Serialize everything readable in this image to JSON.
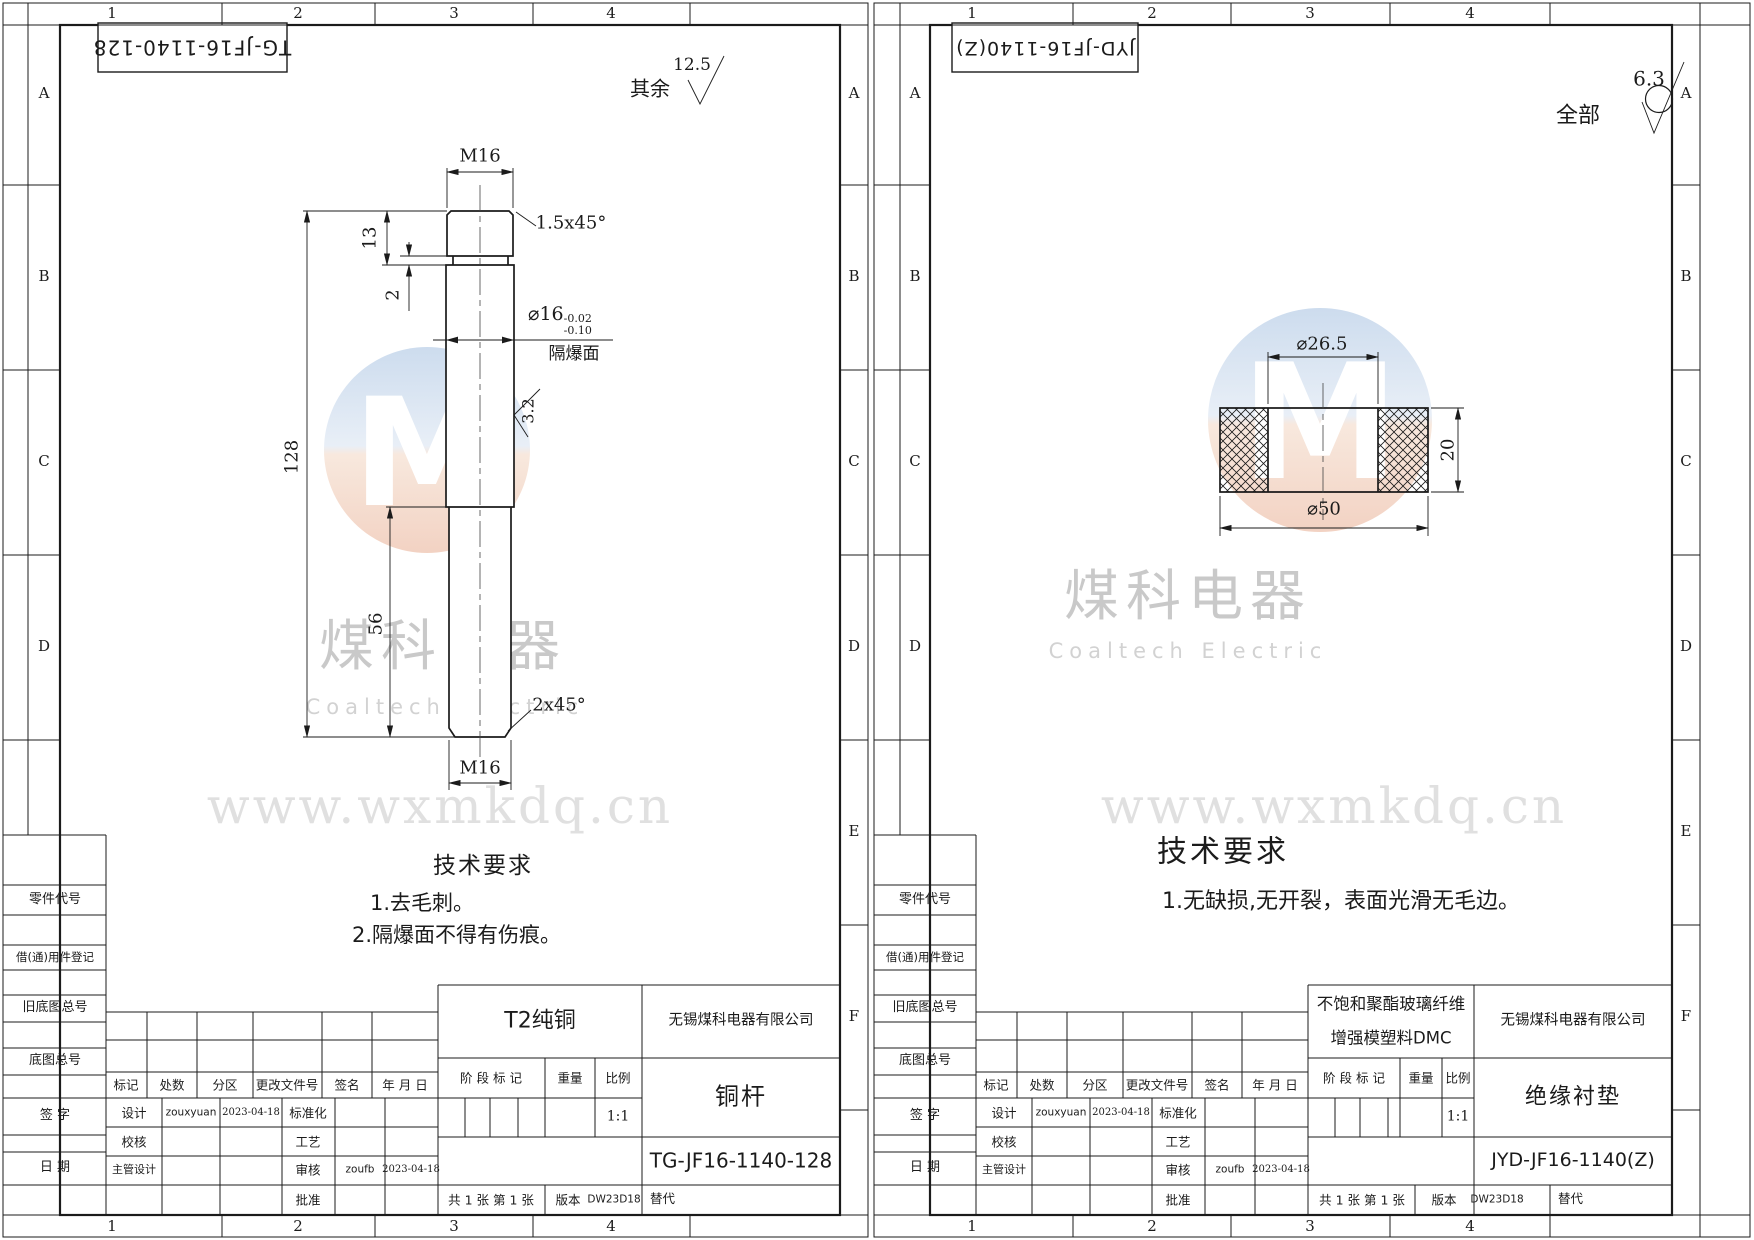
{
  "watermark": {
    "logo_letter": "M",
    "brand_cn": "煤科电器",
    "brand_en": "Coaltech Electric",
    "url": "www.wxmkdq.cn"
  },
  "common": {
    "zone_cols": [
      "1",
      "2",
      "3",
      "4"
    ],
    "zone_rows": [
      "A",
      "B",
      "C",
      "D",
      "E",
      "F"
    ],
    "side_labels": [
      "零件代号",
      "借(通)用件登记",
      "旧底图总号",
      "底图总号",
      "签 字",
      "日 期"
    ],
    "rev_headers": [
      "标记",
      "处数",
      "分区",
      "更改文件号",
      "签名",
      "年 月 日"
    ],
    "sig": {
      "design_label": "设计",
      "design_name": "zouxyuan",
      "design_date": "2023-04-18",
      "std_label": "标准化",
      "check_label": "校核",
      "process_label": "工艺",
      "chief_label": "主管设计",
      "audit_label": "审核",
      "audit_name": "zoufb",
      "audit_date": "2023-04-18",
      "approve_label": "批准"
    },
    "stage_label": "阶 段 标 记",
    "weight_label": "重量",
    "scale_label": "比例",
    "scale_value": "1:1",
    "sheets_note": "共 1 张  第 1 张",
    "version_label": "版本",
    "version_value": "DW23D18",
    "replace_label": "替代",
    "company": "无锡煤科电器有限公司",
    "tech_title": "技术要求"
  },
  "left": {
    "stamp": "TG-JF16-1140-128",
    "finish_prefix": "其余",
    "finish_value": "12.5",
    "material": "T2纯铜",
    "part_name": "铜杆",
    "part_no": "TG-JF16-1140-128",
    "tech_items": [
      "1.去毛刺。",
      "2.隔爆面不得有伤痕。"
    ],
    "dims": {
      "thread_top": "M16",
      "chamfer_top": "1.5x45°",
      "len_head": "13",
      "groove": "2",
      "dia": "⌀16",
      "dia_tol_up": "-0.02",
      "dia_tol_dn": "-0.10",
      "flame_face": "隔爆面",
      "finish_body": "3.2",
      "len_total": "128",
      "len_lower": "56",
      "chamfer_bottom": "2x45°",
      "thread_bottom": "M16"
    }
  },
  "right": {
    "stamp": "JYD-JF16-1140(Z)",
    "finish_prefix": "全部",
    "finish_value": "6.3",
    "material_line1": "不饱和聚酯玻璃纤维",
    "material_line2": "增强模塑料DMC",
    "part_name": "绝缘衬垫",
    "part_no": "JYD-JF16-1140(Z)",
    "tech_items": [
      "1.无缺损,无开裂，表面光滑无毛边。"
    ],
    "dims": {
      "dia_inner": "⌀26.5",
      "height": "20",
      "dia_outer": "⌀50"
    }
  }
}
